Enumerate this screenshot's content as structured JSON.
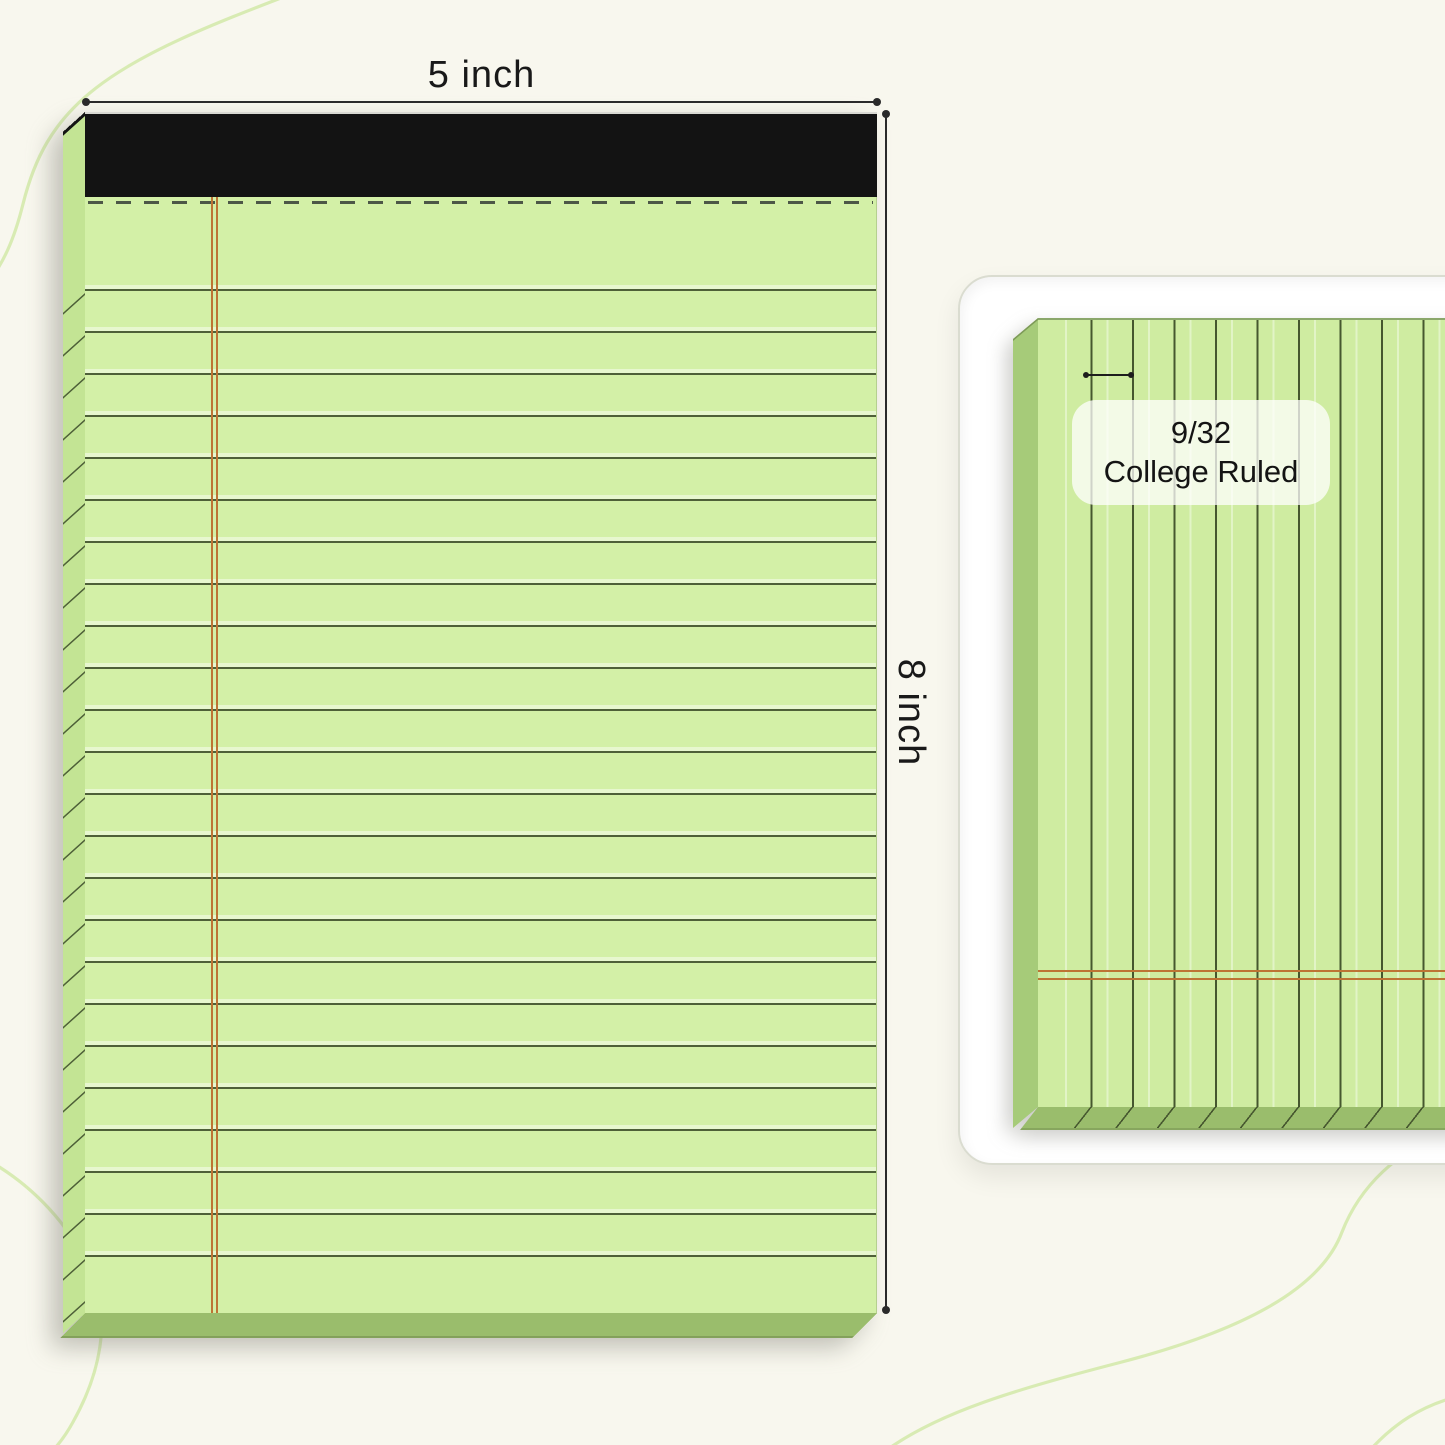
{
  "product_diagram": {
    "width_label": "5 inch",
    "height_label": "8 inch"
  },
  "ruling_detail": {
    "value": "9/32",
    "name": "College Ruled"
  },
  "colors": {
    "background": "#f8f7ee",
    "paper": "#d3f0a7",
    "paper_mini": "#cfeca1",
    "side": "#c3e494",
    "side_mini": "#a6cb79",
    "side_bottom": "#9abd6c",
    "binding": "#131313",
    "rule_line": "#4e6038",
    "rule_line_mini": "#46572f",
    "margin_line": "#bd7434",
    "perforation": "#4c5747",
    "dimension": "#2a2a2a",
    "card_bg": "#ffffff",
    "card_border": "#dadcd0",
    "chip_bg": "rgba(255,255,255,0.74)",
    "decor_curve": "#d8ebb3"
  }
}
